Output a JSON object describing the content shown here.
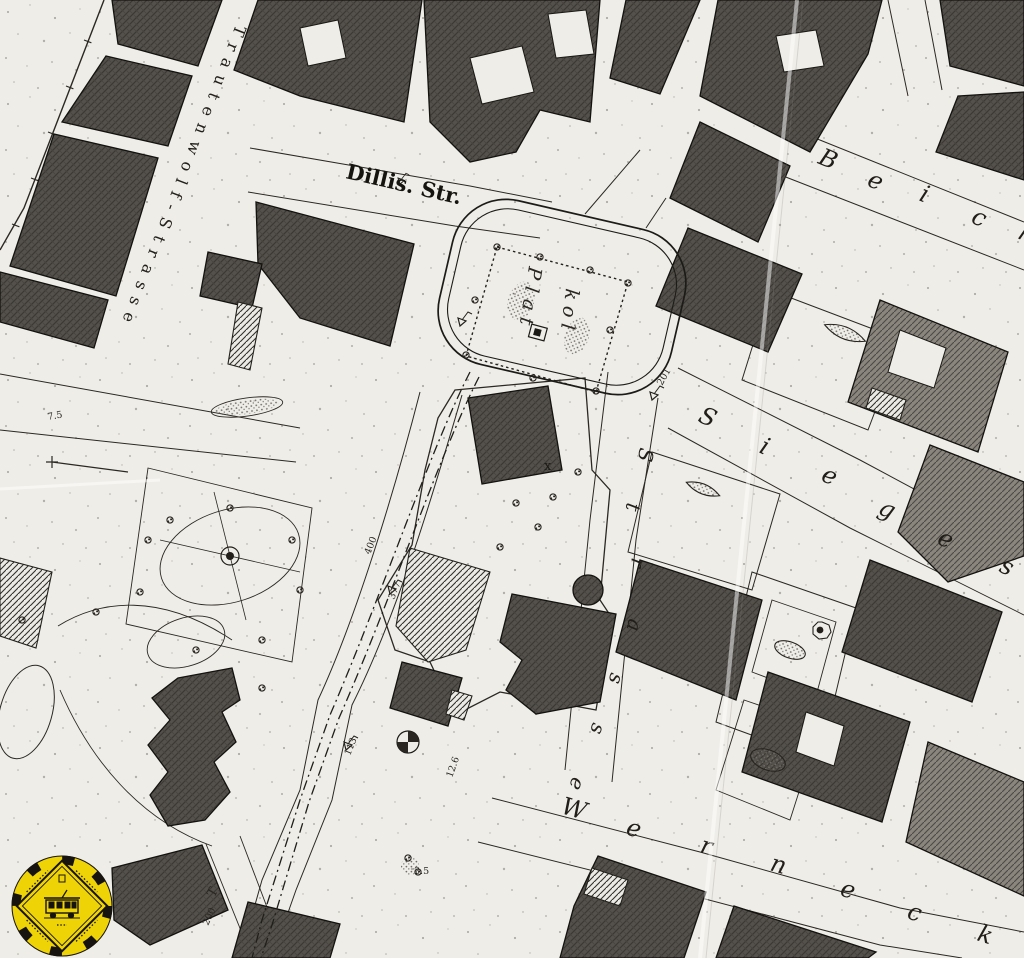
{
  "map": {
    "type": "historical-cadastral-city-map-scan",
    "street_labels": {
      "dillis": {
        "text": "Dillis. Str."
      },
      "trautenwolf": {
        "text": "Trautenwolf-Strasse"
      },
      "sieges": {
        "text": "Sieges"
      },
      "strasse_vertical": {
        "text": "Strasse"
      },
      "beich": {
        "text": "Beich"
      },
      "werneck": {
        "text": "Werneck"
      },
      "platz_col_left": {
        "text": "Plat"
      },
      "platz_col_right": {
        "text": "kol"
      }
    },
    "annotations": {
      "numbers": [
        "400",
        "377",
        "113",
        "201",
        "200",
        "12.6",
        "3.5",
        "7.5"
      ],
      "letter_t": "T",
      "x_mark": "x"
    },
    "colors": {
      "paper": "#efede8",
      "ink": "#1c1a17",
      "block_fill": "#54514c"
    }
  },
  "logo": {
    "name": "tram-museum-seal",
    "description": "yellow circular seal, black diamond double border, historic tram drawing",
    "color_bg": "#eed306",
    "color_fg": "#17130e"
  }
}
